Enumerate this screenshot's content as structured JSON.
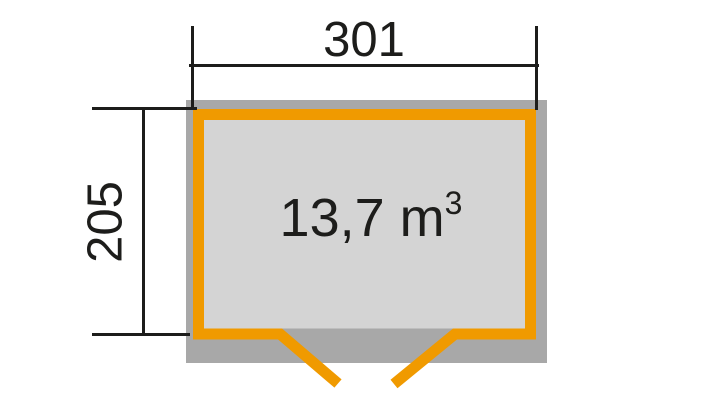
{
  "diagram": {
    "type": "shed-floor-plan",
    "dimensions": {
      "width_label": "301",
      "depth_label": "205"
    },
    "volume": {
      "value_text": "13,7 m",
      "superscript": "3"
    },
    "colors": {
      "accent_orange": "#F09A00",
      "wall_gray": "#A8A8A8",
      "floor_gray": "#D4D4D4",
      "line_black": "#1D1D1B",
      "background": "#FFFFFF"
    }
  }
}
